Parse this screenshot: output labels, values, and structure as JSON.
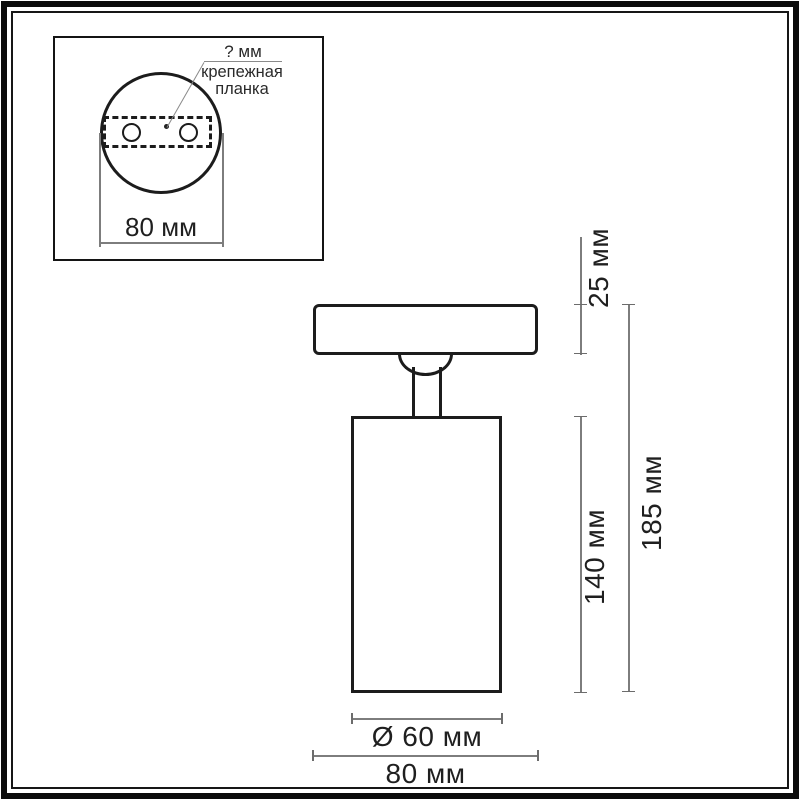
{
  "diagram": {
    "title_hint": "ceiling spot light dimensional drawing",
    "inset": {
      "hole_pitch_label": "? мм",
      "bracket_label_line1": "крепежная",
      "bracket_label_line2": "планка",
      "plate_width": "80 мм"
    },
    "dimensions": {
      "canopy_height": "25 мм",
      "body_height": "140 мм",
      "total_height": "185 мм",
      "body_diameter": "Ø 60 мм",
      "canopy_width": "80 мм"
    },
    "colors": {
      "drawing_line": "#1c1c1c",
      "dimension_line": "#7d7d7d",
      "text": "#1f1f1f",
      "background": "#ffffff"
    }
  }
}
